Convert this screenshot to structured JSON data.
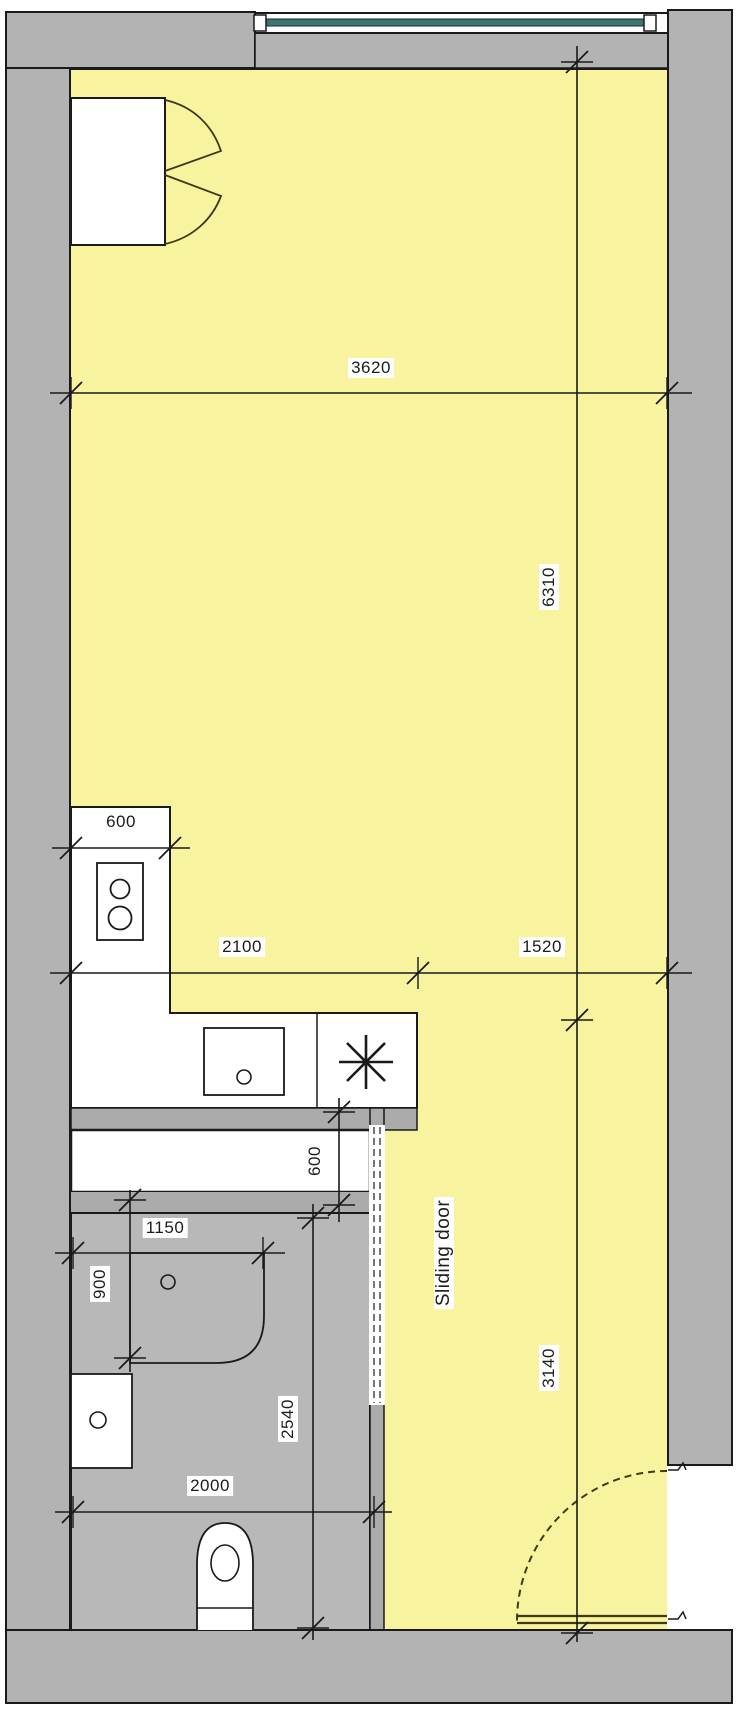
{
  "title": "Studio apartment floor plan",
  "labels": {
    "room_width": "3620",
    "room_length": "6310",
    "counter_depth": "600",
    "kitchen_span_left": "2100",
    "kitchen_span_right": "1520",
    "desk_depth": "600",
    "shower_width": "1150",
    "shower_depth": "900",
    "bathroom_length": "2540",
    "bathroom_width": "2000",
    "entry_length": "3140",
    "sliding_door": "Sliding door"
  },
  "colors": {
    "floor_yellow": "#f7f39e",
    "wall_gray": "#b3b3b3",
    "band_gray": "#ababab",
    "bath_gray": "#b8b8b8",
    "line_black": "#1a1a1a",
    "window_glass": "#3f7472",
    "door_olive": "#3c3c14"
  },
  "fixtures": [
    "window",
    "wardrobe",
    "stove-cooktop",
    "kitchen-sink",
    "burner-symbol",
    "desk",
    "shower",
    "washbasin",
    "toilet",
    "sliding-door",
    "swing-door"
  ]
}
